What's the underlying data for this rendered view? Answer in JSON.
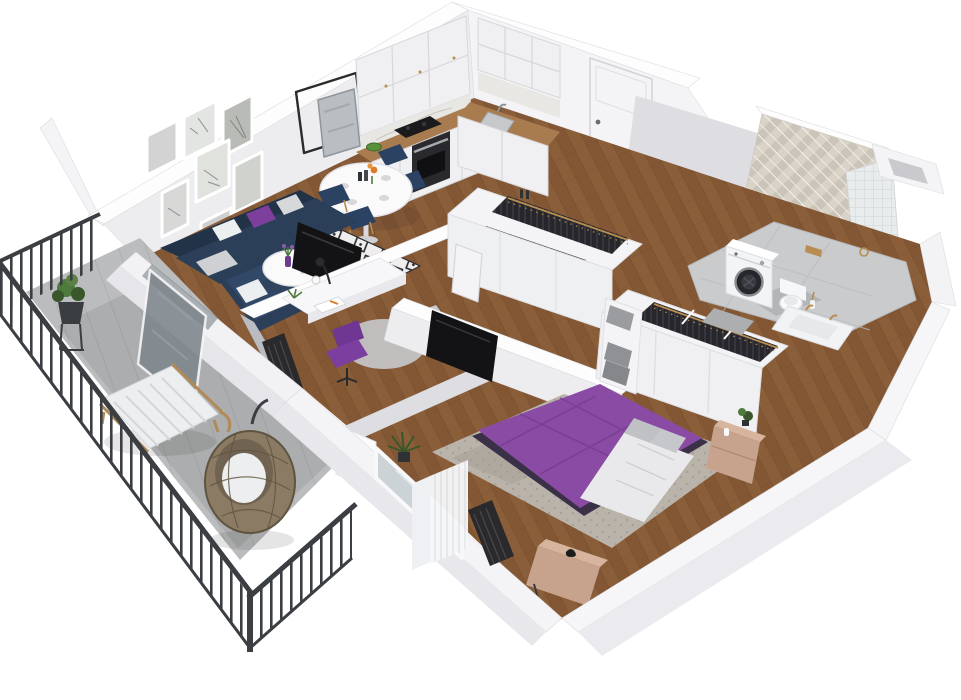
{
  "scene": {
    "type": "isometric-3d-apartment-floorplan-render",
    "background": "#ffffff",
    "rooms": [
      {
        "name": "living-room",
        "furniture": [
          "navy-corner-sofa",
          "purple-pillow",
          "gray-white-pillows",
          "black-white-diamond-rug",
          "round-white-coffee-table",
          "purple-vase-with-flowers",
          "wall-tv",
          "gallery-wall-seven-framed-prints",
          "leaning-mirror",
          "thin-black-square-frame",
          "radiator",
          "open-glass-balcony-door"
        ]
      },
      {
        "name": "dining-area",
        "furniture": [
          "oval-white-pedestal-table",
          "four-navy-chairs-gold-legs",
          "table-setting-plates",
          "orange-flowers"
        ]
      },
      {
        "name": "kitchen",
        "furniture": [
          "white-upper-cabinets-gold-knobs",
          "white-lower-cabinets",
          "wood-countertop",
          "marble-backsplash",
          "black-cooktop",
          "built-in-oven",
          "steel-sink-with-faucet",
          "green-bowl"
        ]
      },
      {
        "name": "entrance-hall",
        "furniture": [
          "white-entrance-door",
          "open-wardrobe-with-dark-hanging-clothes",
          "herringbone-wood-floor",
          "white-interior-door"
        ]
      },
      {
        "name": "bathroom",
        "furniture": [
          "chevron-tile-feature-wall",
          "white-grid-tile-half-wall",
          "washing-machine",
          "wall-hung-toilet",
          "gold-flush-plate",
          "vanity-bathtub-with-gold-faucet",
          "gray-marble-tile-floor",
          "bath-mat",
          "installation-shaft",
          "white-door-ajar"
        ]
      },
      {
        "name": "bedroom",
        "furniture": [
          "double-bed-purple-bedspread",
          "white-duvet",
          "gray-pillows",
          "mottled-gray-rug",
          "wood-nightstand-with-plant",
          "wood-foot-bench",
          "black-bird-figurine",
          "sliding-closet-with-hanging-clothes",
          "gray-storage-boxes",
          "radiator",
          "window-with-sheer-curtains",
          "potted-palm",
          "wall-tv-facing-bed"
        ]
      },
      {
        "name": "home-office-nook",
        "furniture": [
          "white-desk",
          "desk-lamp",
          "open-magazine",
          "purple-swivel-chair",
          "round-gray-rug",
          "gray-armchair",
          "radiator",
          "desk-plant"
        ]
      },
      {
        "name": "balcony",
        "furniture": [
          "black-metal-bar-railing",
          "concrete-tile-floor",
          "rattan-hanging-egg-chair",
          "wood-lounger-striped-cushion",
          "potted-plant-on-black-stand",
          "swung-open-glass-door"
        ]
      }
    ],
    "gallery_wall": {
      "frames_count": 7,
      "leaning_items": [
        "square-black-frame",
        "tilted-mirror"
      ]
    }
  },
  "palette": {
    "wall-top": "#fdfdfe",
    "wall-face": "#ededf0",
    "wall-face-light": "#f4f4f6",
    "wall-face-dark": "#dddde2",
    "wall-shadow": "#b9bcc2",
    "floor-wood": "#8b5e3a",
    "floor-wood-dark": "#73492a",
    "balcony-floor": "#babcbd",
    "balcony-plank": "#a6a8aa",
    "railing": "#3b3e42",
    "glass": "#7e868c",
    "sofa": "#2b4058",
    "sofa-dark": "#223348",
    "pillow-purple": "#7c3f9b",
    "pillow-light": "#eceff0",
    "pillow-gray": "#c0c1c5",
    "rug-base": "#efeeec",
    "rug-diamond": "#2c2c30",
    "table-white": "#fafafb",
    "chair-navy": "#2c4263",
    "gold": "#b98d4f",
    "counter-wood": "#a97c50",
    "cabinet": "#f0f0f3",
    "cabinet-line": "#d7d7db",
    "cooktop": "#1b1b1d",
    "oven": "#2a2a2e",
    "steel": "#c6c9cb",
    "bowl-green": "#59903b",
    "backsplash": "#e9e7e3",
    "door-white": "#f4f4f6",
    "clothes-dark": "#26262c",
    "clothes-stripe": "#3c3c44",
    "tile-a": "#d8d2c7",
    "tile-b": "#cbc4b8",
    "tile-grid": "#e9eced",
    "bath-floor": "#c9cbcd",
    "bath-mat": "#acaeb0",
    "bed-purple": "#8a4ba4",
    "bed-purple-dark": "#743c8d",
    "duvet": "#e9e9eb",
    "bedroom-rug": "#b9b3aa",
    "wood-furniture": "#c7a28c",
    "wood-furniture-top": "#d6b49d",
    "radiator": "#2a2a2c",
    "curtain": "#f6f7f9",
    "tv-black": "#131315",
    "chair-purple": "#7b3fa0",
    "office-rug": "#c6c7c9",
    "armchair": "#d8d9db",
    "egg-chair": "#8b7b64",
    "egg-chair-dark": "#5f543f",
    "lounger-wood": "#b28a58",
    "cushion": "#edeef0",
    "plant-green": "#4e7a3c",
    "plant-dark": "#39572b",
    "shadow": "rgba(40,40,45,0.12)"
  }
}
